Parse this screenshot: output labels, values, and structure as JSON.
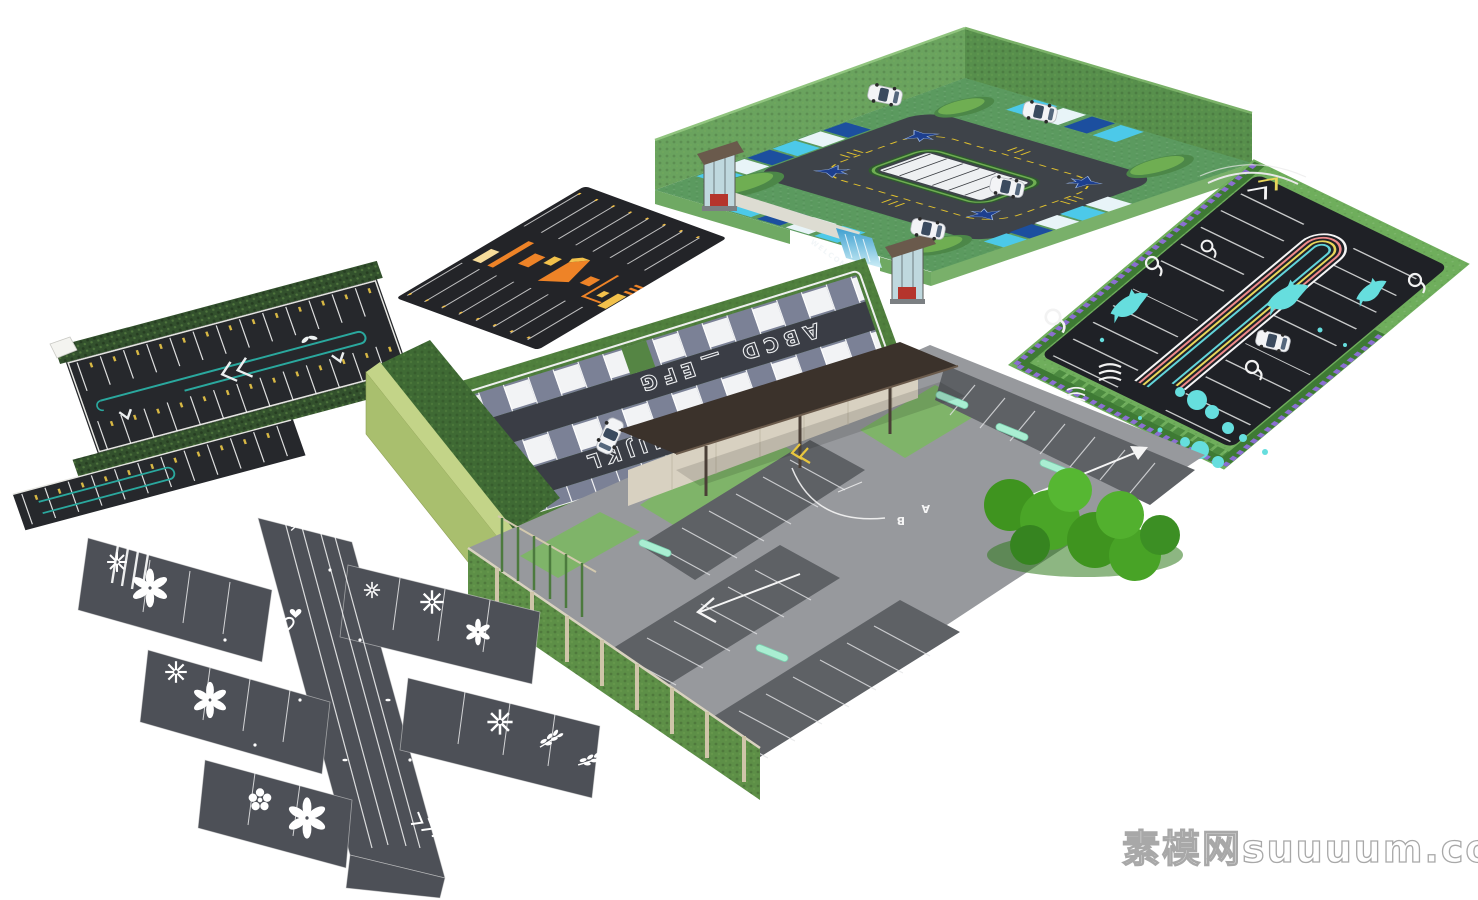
{
  "page": {
    "width": 1478,
    "height": 900,
    "background": "#ffffff",
    "subject": "Isometric 3D model collection of seven landscaped parking lot designs on a white backdrop"
  },
  "watermark": {
    "text": "素模网suuuum.com"
  },
  "models": {
    "walled_lot": {
      "name": "Green-walled parking lot with guard booths and jet road graphics",
      "welcome_text": "WELCOME",
      "car_count": 4,
      "guard_booth_count": 2,
      "colors": {
        "wall": "#6aa35e",
        "wall_side": "#578f4c",
        "paver": "#5b9a5f",
        "asphalt": "#3e4349",
        "stall_cyan": "#4cc9e9",
        "stall_blue": "#1c4f9f",
        "marking_yellow": "#e2c22e",
        "jet_blue": "#1d3f8f",
        "island_white": "#eef0f2",
        "waterfall": "#3e9fd0"
      }
    },
    "ocean_lot": {
      "name": "Ocean themed lot with dolphins and rainbow guide stripes",
      "car_count": 1,
      "stripe_colors": [
        "#f5f5f5",
        "#ef8a8a",
        "#e8d65a",
        "#62d4da"
      ],
      "colors": {
        "asphalt": "#1f2126",
        "grass": "#6fae5c",
        "hedge_purple": "#8a6fd1",
        "shrub_green": "#3e7a34",
        "dolphin": "#66dede",
        "paint_white": "#f2f2f2"
      }
    },
    "orange_lot": {
      "name": "Black asphalt lot with orange supergraphic arrows",
      "colors": {
        "asphalt": "#232428",
        "orange": "#ee8327",
        "yellow": "#f2c14b",
        "pale": "#f7dc9a"
      }
    },
    "letter_lot": {
      "name": "Strip lot with painted stall letters",
      "stall_labels": [
        "ABCD",
        "EFG",
        "HIJKL"
      ],
      "separator": "—",
      "car_count": 1,
      "colors": {
        "aisle": "#3a3d45",
        "slab_slate": "#7b8196",
        "slab_white": "#f2f3f5",
        "grass": "#4f7f3d",
        "wall_olive": "#a9bf6e"
      }
    },
    "teal_strip_lot": {
      "name": "Hedge-lined strip lot with teal guide loop",
      "colors": {
        "asphalt": "#26282c",
        "hedge": "#33512d",
        "teal": "#2aa89e",
        "tick_yellow": "#d8b844",
        "curb_white": "#e6e6e2"
      }
    },
    "flower_lot": {
      "name": "Gray lot painted with white flowers, leaves and hearts",
      "colors": {
        "asphalt": "#4d5057",
        "paint": "#ffffff"
      }
    },
    "canopy_lot": {
      "name": "Gated lot with entrance canopy, living walls and mint stall accents",
      "lane_letters": [
        "B",
        "A"
      ],
      "colors": {
        "deck": "#97999d",
        "stall": "#5e6165",
        "mint": "#a9eed2",
        "canopy": "#3b322b",
        "stone_wall": "#d8d1c1",
        "hedge": "#46a02a",
        "living_wall": "#5d8f47",
        "chevron_yellow": "#e8c63e"
      }
    }
  },
  "icons": {
    "car": "top-view white car",
    "jet": "blue fighter-jet pavement graphic",
    "dolphin": "cyan dolphin pavement graphic",
    "swirl": "white marine swirl pavement graphic",
    "waves": "white wave lines pavement graphic",
    "flower": "six-petal flower pavement paint",
    "spinner": "pinwheel flower pavement paint",
    "daisy": "five-petal daisy pavement paint",
    "branch": "leaf branch pavement paint",
    "heart": "heart outline pavement paint",
    "chevron": "chevron arrow road marking",
    "guard-booth": "glass guard booth with brown roof",
    "mint-pill": "mint capsule stall accent"
  }
}
